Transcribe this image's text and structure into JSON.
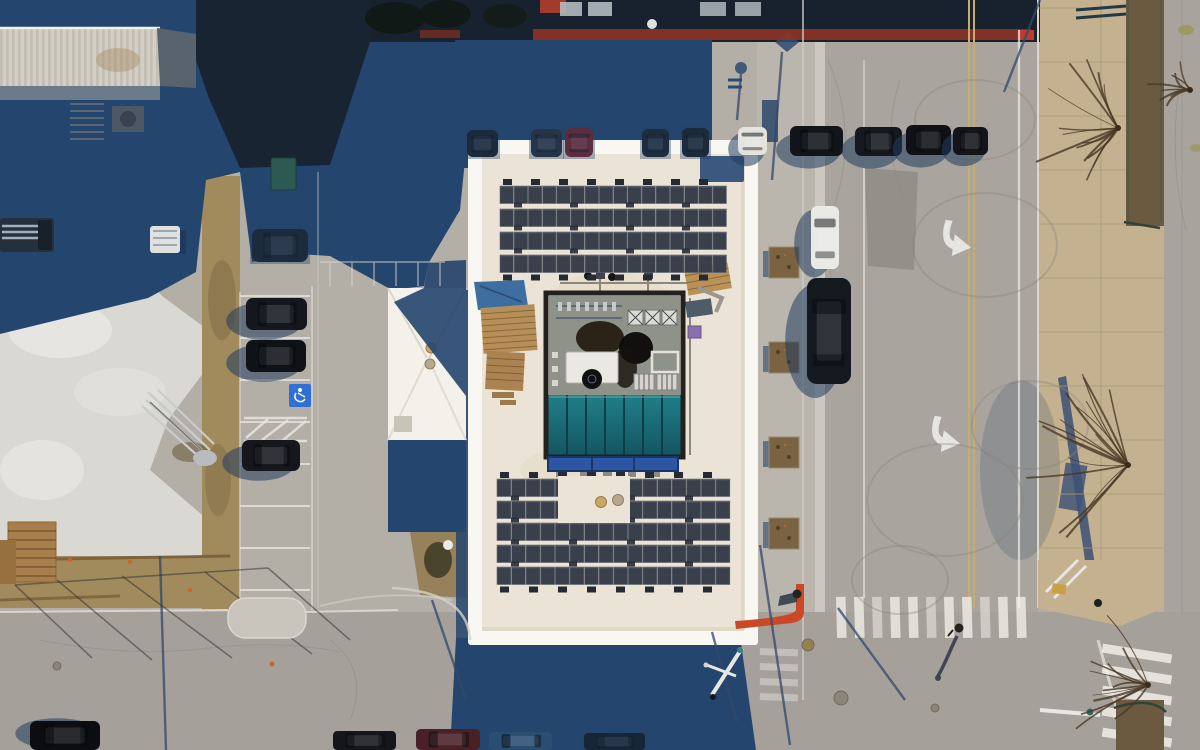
{
  "scene": {
    "subject": "aerial-drone-view-of-flat-roof-building-with-rooftop-solar-arrays-parking-lots-and-street-intersection"
  },
  "palette": {
    "pavement": "#b3aea6",
    "pavement_bright": "#c8c4bc",
    "concrete_white": "#dad8d2",
    "asphalt": "#a9a59e",
    "asphalt_bottom": "#a5a19a",
    "gutter": "#ccc8c0",
    "shadow": "#24456d",
    "shadow_deep": "#18222e",
    "shadow_soft": "#32486b",
    "roof_white": "#f8f7f2",
    "roof_inner": "#ebe4d6",
    "panel": "#3a404b",
    "panel_line": "#5d646e",
    "ballast": "#262b33",
    "teal_hi": "#20808a",
    "teal_lo": "#135560",
    "band_blue": "#2d56a4",
    "dirt": "#a18a5c",
    "dirt_dark": "#6b5a3f",
    "sidewalk": "#c3b190",
    "sidewalk_line": "#ab9a74",
    "yellow_line": "#c9ac68",
    "white_mark": "#f2f0ea",
    "red_curb": "#cb4827",
    "branch": "#4a3826",
    "mech_floor": "#8e9289",
    "car_shadow": "#203c5e"
  },
  "solar_arrays": [
    {
      "name": "solar-array-top",
      "x": 500,
      "y": 186,
      "cols": 16,
      "rows": 4,
      "cellW": 14.2,
      "cellH": 17.5,
      "rowGap": 5.5,
      "ballastStep": 28,
      "gaps": []
    },
    {
      "name": "solar-array-bottom",
      "x": 497,
      "y": 479,
      "cols": 16,
      "rows": 5,
      "cellW": 14.6,
      "cellH": 17.5,
      "rowGap": 4.5,
      "ballastStep": 29,
      "gaps": [
        {
          "x": 558,
          "y": 476,
          "w": 72,
          "h": 47
        }
      ]
    }
  ],
  "skylight": {
    "x": 548,
    "y": 395,
    "w": 133,
    "h": 60,
    "panes": 7
  },
  "vehicles": [
    {
      "name": "parked-car",
      "x": 467,
      "y": 130,
      "w": 31,
      "h": 27,
      "c": "#171b23",
      "kind": "v",
      "dim": true
    },
    {
      "name": "parked-car",
      "x": 531,
      "y": 129,
      "w": 31,
      "h": 28,
      "c": "#262b35",
      "kind": "v",
      "dim": true
    },
    {
      "name": "parked-car-red",
      "x": 565,
      "y": 128,
      "w": 28,
      "h": 29,
      "c": "#7e2023",
      "kind": "v",
      "dim": true
    },
    {
      "name": "parked-car",
      "x": 642,
      "y": 129,
      "w": 27,
      "h": 28,
      "c": "#1a1e26",
      "kind": "v",
      "dim": true
    },
    {
      "name": "parked-car",
      "x": 682,
      "y": 128,
      "w": 27,
      "h": 29,
      "c": "#161a21",
      "kind": "v",
      "dim": true
    },
    {
      "name": "parked-car",
      "x": 252,
      "y": 229,
      "w": 56,
      "h": 33,
      "c": "#171b22",
      "kind": "h",
      "dim": true
    },
    {
      "name": "parked-car-white",
      "x": 738,
      "y": 127,
      "w": 29,
      "h": 28,
      "c": "#e4e3de",
      "kind": "v",
      "shadow": [
        -6,
        8
      ]
    },
    {
      "name": "parked-car",
      "x": 790,
      "y": 126,
      "w": 53,
      "h": 30,
      "c": "#111419",
      "kind": "h",
      "shadow": [
        -8,
        9
      ]
    },
    {
      "name": "parked-car",
      "x": 855,
      "y": 127,
      "w": 47,
      "h": 29,
      "c": "#15181e",
      "kind": "h",
      "shadow": [
        -8,
        9
      ]
    },
    {
      "name": "parked-car",
      "x": 906,
      "y": 125,
      "w": 45,
      "h": 30,
      "c": "#0f1117",
      "kind": "h",
      "shadow": [
        -8,
        9
      ]
    },
    {
      "name": "parked-car",
      "x": 953,
      "y": 127,
      "w": 35,
      "h": 28,
      "c": "#13151b",
      "kind": "h",
      "shadow": [
        -7,
        8
      ]
    },
    {
      "name": "parked-car",
      "x": 246,
      "y": 298,
      "w": 61,
      "h": 32,
      "c": "#14171d",
      "kind": "h",
      "shadow": [
        -12,
        7
      ]
    },
    {
      "name": "parked-car",
      "x": 246,
      "y": 340,
      "w": 60,
      "h": 32,
      "c": "#0f1217",
      "kind": "h",
      "shadow": [
        -12,
        7
      ]
    },
    {
      "name": "parked-car",
      "x": 242,
      "y": 440,
      "w": 58,
      "h": 31,
      "c": "#15171c",
      "kind": "h",
      "shadow": [
        -12,
        7
      ]
    },
    {
      "name": "street-car-white",
      "x": 811,
      "y": 206,
      "w": 28,
      "h": 63,
      "c": "#e9eae6",
      "kind": "v",
      "shadow": [
        -11,
        6
      ]
    },
    {
      "name": "street-car-dark",
      "x": 807,
      "y": 278,
      "w": 44,
      "h": 106,
      "c": "#14181f",
      "kind": "v",
      "shadow": [
        -14,
        10
      ]
    },
    {
      "name": "parked-car",
      "x": 30,
      "y": 721,
      "w": 70,
      "h": 29,
      "c": "#0b0d11",
      "kind": "h",
      "shadow": [
        -8,
        -2
      ]
    },
    {
      "name": "parked-car",
      "x": 333,
      "y": 731,
      "w": 63,
      "h": 19,
      "c": "#15161b",
      "kind": "h"
    },
    {
      "name": "parked-car-maroon",
      "x": 416,
      "y": 729,
      "w": 64,
      "h": 21,
      "c": "#482026",
      "kind": "h"
    },
    {
      "name": "parked-car-blue",
      "x": 489,
      "y": 732,
      "w": 63,
      "h": 18,
      "c": "#2a4d72",
      "kind": "h"
    },
    {
      "name": "parked-car",
      "x": 584,
      "y": 733,
      "w": 61,
      "h": 17,
      "c": "#0e1319",
      "kind": "h",
      "dim": true
    }
  ],
  "parking": {
    "x1": 240,
    "x2": 310,
    "stall_line_ys": [
      296,
      338,
      380,
      422,
      464,
      506,
      548,
      590
    ]
  },
  "planters": {
    "x": 769,
    "w": 30,
    "h": 31,
    "ys": [
      247,
      342,
      437,
      518
    ]
  },
  "crosswalks": {
    "bottom": {
      "x0": 836,
      "y": 597,
      "count": 11,
      "step": 18,
      "w": 9.5,
      "h": 41,
      "rot": -1.5
    },
    "corner": {
      "x": 1102,
      "y0": 649,
      "count": 5,
      "stepY": 21,
      "w": 70,
      "h": 9,
      "rot": 9
    },
    "small": {
      "x": 760,
      "y0": 648,
      "count": 4,
      "stepY": 15,
      "w": 38,
      "h": 7,
      "rot": 2,
      "opacity": 0.32
    }
  },
  "turn_arrows": [
    {
      "x": 952,
      "y": 247,
      "rot": 8
    },
    {
      "x": 941,
      "y": 443,
      "rot": 8
    }
  ],
  "skid_marks": [
    {
      "cx": 985,
      "cy": 245,
      "rx": 72,
      "ry": 52
    },
    {
      "cx": 1030,
      "cy": 425,
      "rx": 58,
      "ry": 44
    },
    {
      "cx": 945,
      "cy": 500,
      "rx": 78,
      "ry": 56
    },
    {
      "cx": 900,
      "cy": 580,
      "rx": 48,
      "ry": 34
    },
    {
      "cx": 975,
      "cy": 120,
      "rx": 60,
      "ry": 40
    }
  ],
  "trees": [
    {
      "cx": 1118,
      "cy": 128,
      "r": 95,
      "n": 14
    },
    {
      "cx": 1128,
      "cy": 465,
      "r": 110,
      "n": 16
    },
    {
      "cx": 1148,
      "cy": 685,
      "r": 85,
      "n": 12
    },
    {
      "cx": 1190,
      "cy": 90,
      "r": 45,
      "n": 8
    }
  ],
  "pole_shadow_lines": [
    [
      782,
      52,
      772,
      180
    ],
    [
      741,
      74,
      737,
      120
    ],
    [
      1040,
      0,
      1004,
      92
    ],
    [
      760,
      545,
      790,
      745
    ],
    [
      712,
      632,
      737,
      722
    ],
    [
      160,
      556,
      166,
      750
    ],
    [
      838,
      608,
      905,
      700
    ],
    [
      432,
      600,
      466,
      700
    ]
  ],
  "fence_shadow_lines": [
    [
      15,
      585,
      92,
      658
    ],
    [
      57,
      580,
      152,
      660
    ],
    [
      122,
      576,
      232,
      658
    ],
    [
      205,
      572,
      312,
      654
    ],
    [
      268,
      568,
      350,
      640
    ],
    [
      15,
      585,
      268,
      568
    ]
  ],
  "manholes": [
    {
      "cx": 808,
      "cy": 645,
      "r": 6,
      "c": "#97804f"
    },
    {
      "cx": 841,
      "cy": 698,
      "r": 7,
      "c": "#8b8478"
    },
    {
      "cx": 249,
      "cy": 627,
      "r": 8,
      "c": "#8a6a42"
    },
    {
      "cx": 935,
      "cy": 708,
      "r": 4,
      "c": "#8b8478"
    },
    {
      "cx": 57,
      "cy": 666,
      "r": 4,
      "c": "#8b8478"
    }
  ]
}
